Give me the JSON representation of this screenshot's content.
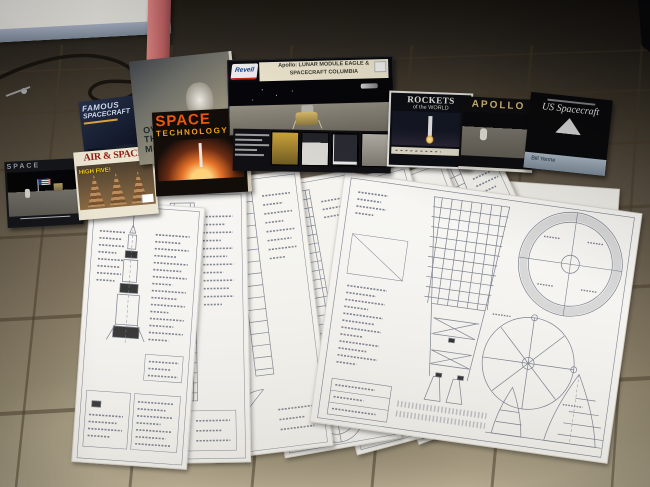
{
  "scene": {
    "description": "Photograph of a spaceflight collection on a tan tiled floor: books, a magazine, a Revell Apollo model kit box and a fan of eight large Saturn V blueprint sheets.",
    "colors": {
      "wall": "#d6d4cf",
      "baseboard_blue": "#8e99ac",
      "door_trim_pink": "#b45c5e",
      "tile_tan": "#b3a88c",
      "blueprint_paper": "#f6f5f1",
      "blueprint_ink": "#6a7080"
    }
  },
  "kit_box": {
    "brand": "Revell",
    "title_line1": "Apollo: LUNAR MODULE EAGLE &",
    "title_line2": "SPACECRAFT COLUMBIA"
  },
  "items": {
    "moon_booklet": {
      "title": "SPACE"
    },
    "famous_spacecraft": {
      "line1": "FAMOUS",
      "line2": "SPACECRAFT"
    },
    "air_space_magazine": {
      "masthead": "AIR & SPACE",
      "cover_line": "HIGH FIVE!"
    },
    "moon_poster": {
      "line1": "OVER",
      "line2": "THE",
      "line3": "MOON"
    },
    "space_technology": {
      "line1": "SPACE",
      "line2": "TECHNOLOGY"
    },
    "rockets_of_the_world": {
      "line1": "ROCKETS",
      "line2": "of the WORLD"
    },
    "apollo_book": {
      "title": "APOLLO"
    },
    "us_spacecraft": {
      "title": "US Spacecraft",
      "author": "Bill Yenne"
    }
  },
  "blueprints": {
    "sheet_count": 8,
    "subject": "Saturn V technical drawing sheets fanned on the floor"
  }
}
